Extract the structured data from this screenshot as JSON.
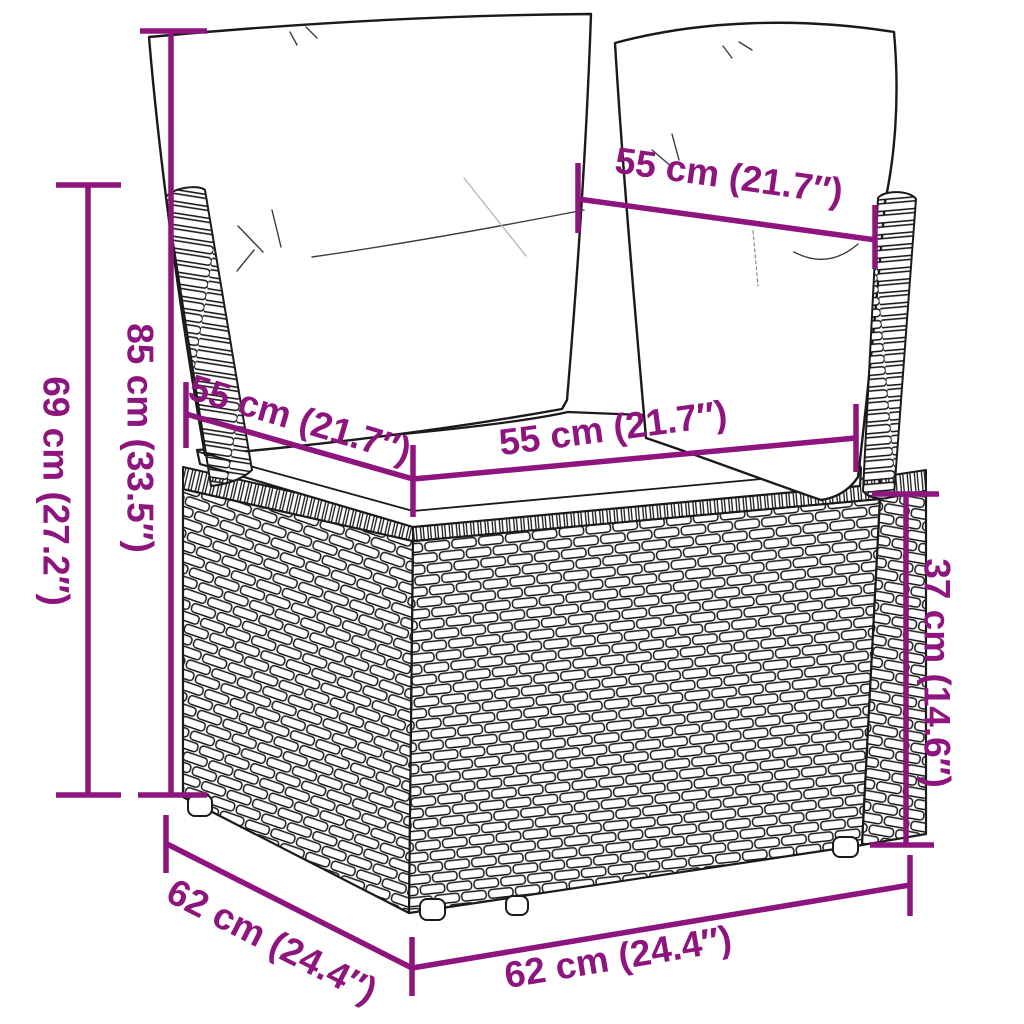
{
  "diagram": {
    "accent_color": "#8E157E",
    "line_color": "#1a1a1a",
    "background_color": "#ffffff",
    "subject": "poly-rattan corner sofa section with two back cushions and a seat cushion",
    "dimensions": {
      "total_height": {
        "label": "69 cm (27.2″)",
        "cm": 69,
        "inches": 27.2
      },
      "back_height": {
        "label": "85 cm (33.5″)",
        "cm": 85,
        "inches": 33.5
      },
      "back_cushion_width": {
        "label": "55 cm (21.7″)",
        "cm": 55,
        "inches": 21.7
      },
      "seat_depth": {
        "label": "55 cm (21.7″)",
        "cm": 55,
        "inches": 21.7
      },
      "seat_width": {
        "label": "55 cm (21.7″)",
        "cm": 55,
        "inches": 21.7
      },
      "seat_height": {
        "label": "37 cm (14.6″)",
        "cm": 37,
        "inches": 14.6
      },
      "base_depth": {
        "label": "62 cm (24.4″)",
        "cm": 62,
        "inches": 24.4
      },
      "base_width": {
        "label": "62 cm (24.4″)",
        "cm": 62,
        "inches": 24.4
      }
    }
  }
}
